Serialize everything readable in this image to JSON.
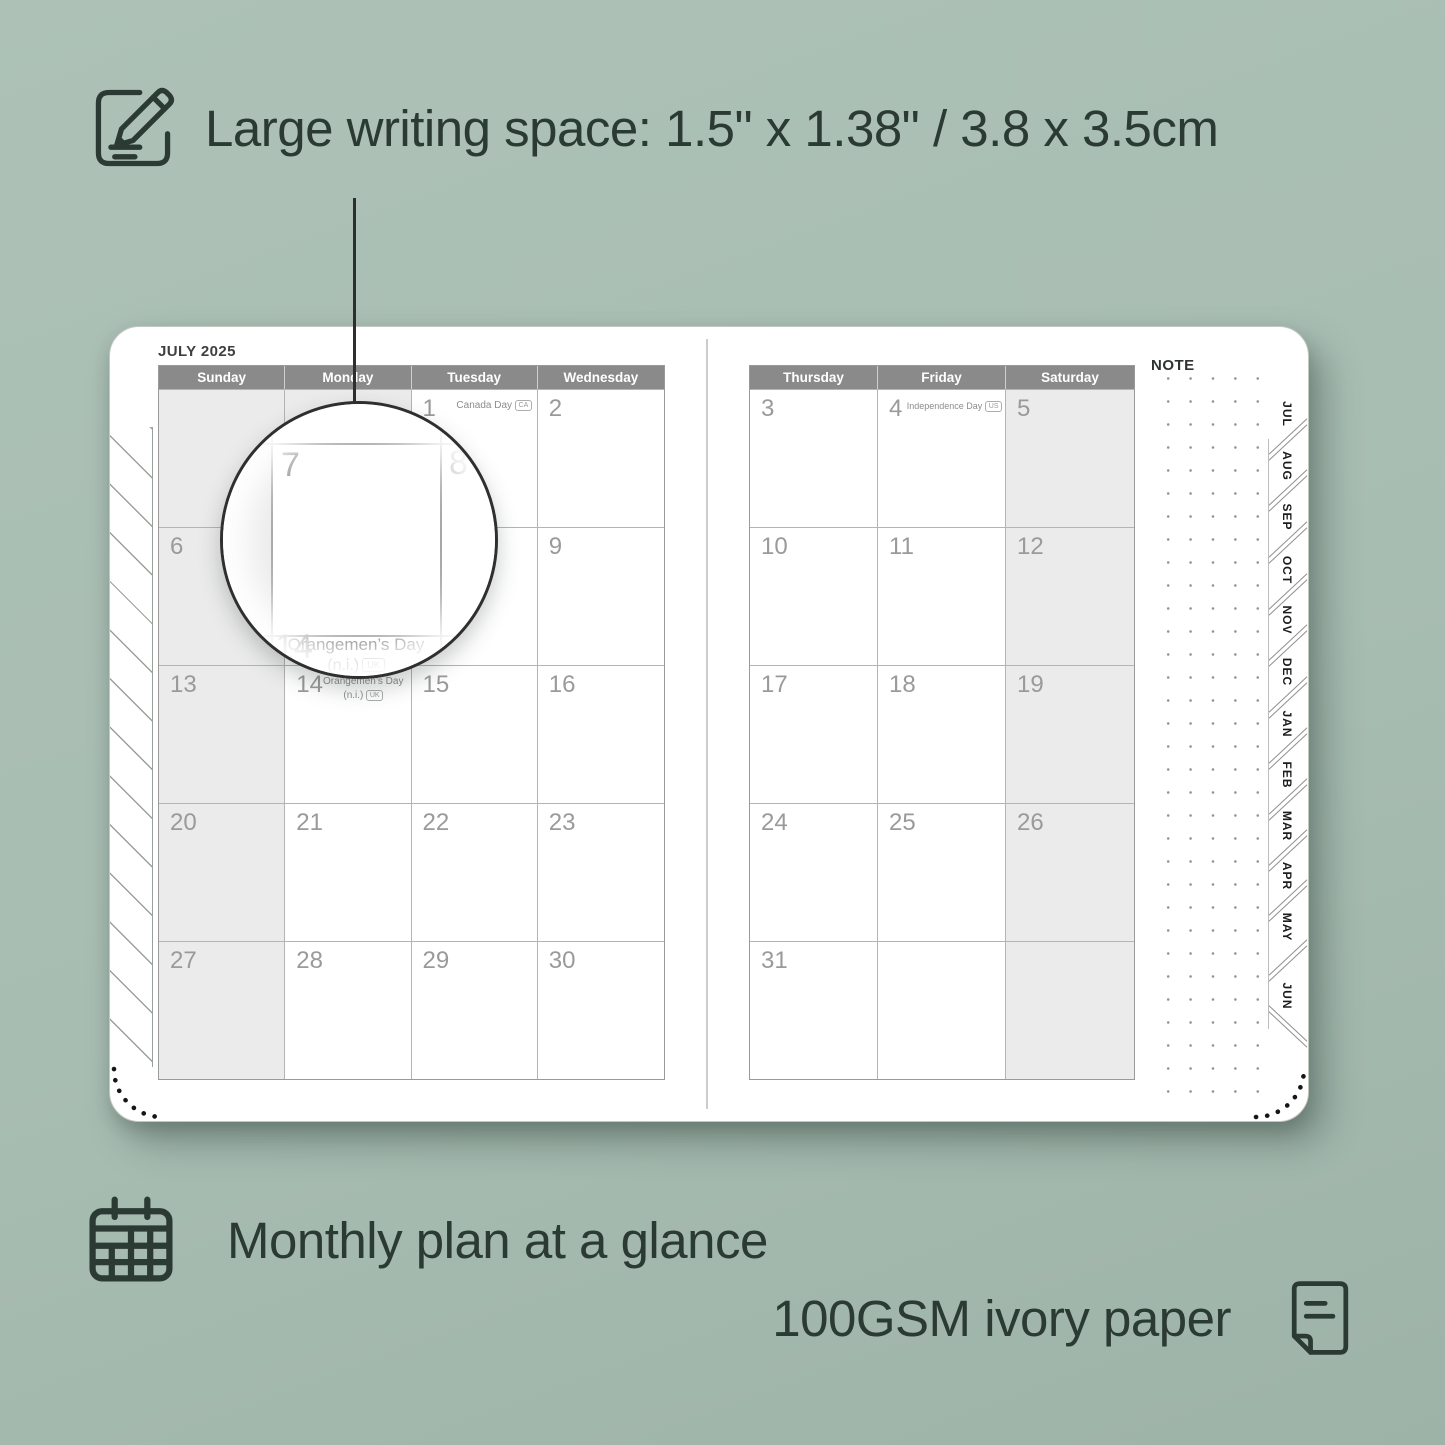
{
  "features": {
    "writing_space": "Large writing space: 1.5\" x 1.38\" / 3.8 x 3.5cm",
    "monthly": "Monthly plan at a glance",
    "paper": "100GSM ivory paper"
  },
  "calendar": {
    "title": "JULY 2025",
    "left_headers": [
      "Sunday",
      "Monday",
      "Tuesday",
      "Wednesday"
    ],
    "right_headers": [
      "Thursday",
      "Friday",
      "Saturday"
    ],
    "left_rows": [
      [
        "",
        "",
        "1",
        "2"
      ],
      [
        "6",
        "7",
        "8",
        "9"
      ],
      [
        "13",
        "14",
        "15",
        "16"
      ],
      [
        "20",
        "21",
        "22",
        "23"
      ],
      [
        "27",
        "28",
        "29",
        "30"
      ]
    ],
    "right_rows": [
      [
        "3",
        "4",
        "5"
      ],
      [
        "10",
        "11",
        "12"
      ],
      [
        "17",
        "18",
        "19"
      ],
      [
        "24",
        "25",
        "26"
      ],
      [
        "31",
        "",
        ""
      ]
    ],
    "holidays": {
      "canada": {
        "name": "Canada Day",
        "badge": "CA"
      },
      "independence": {
        "name": "Independence Day",
        "badge": "US"
      },
      "orangemen": {
        "line1": "Orangemen’s Day",
        "line2": "(n.i.)",
        "badge": "UK"
      }
    }
  },
  "magnifier": {
    "day": "7",
    "day_right": "8",
    "day_below": "14",
    "holiday_line1": "Orangemen’s Day",
    "holiday_line2": "(n.i.)",
    "holiday_badge": "UK"
  },
  "note_label": "NOTE",
  "tabs": [
    "JUL",
    "AUG",
    "SEP",
    "OCT",
    "NOV",
    "DEC",
    "JAN",
    "FEB",
    "MAR",
    "APR",
    "MAY",
    "JUN"
  ],
  "colors": {
    "background": "#a8bdb2",
    "ink": "#2b3a33",
    "header_bar": "#8a8a8a",
    "weekend_shade": "#ebebeb",
    "page": "#ffffff"
  }
}
